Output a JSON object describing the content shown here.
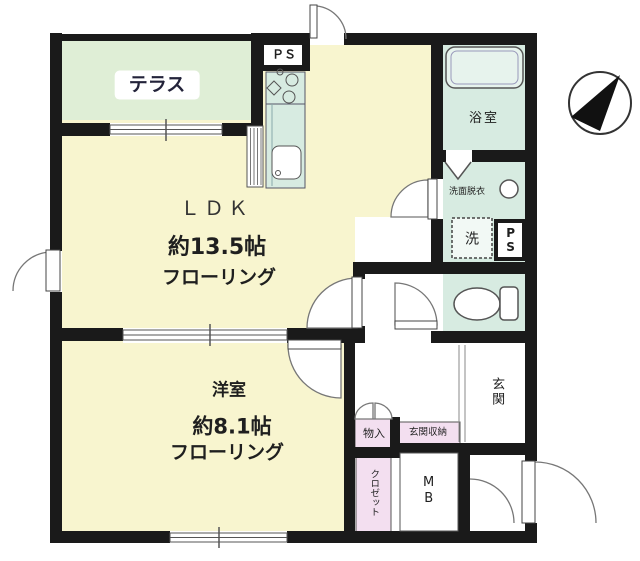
{
  "plan": {
    "colors": {
      "room": "#f8f5cf",
      "terrace": "#dfeed6",
      "wet": "#d7ebe1",
      "storage": "#f3dff0",
      "tub": "#e7f3ed",
      "washer_bg": "#f2f9f5",
      "wall": "#1a1a1a"
    },
    "labels": {
      "terrace": "テラス",
      "ldk": "ＬＤＫ",
      "ldk_size": "約13.5帖",
      "ldk_floor": "フローリング",
      "room": "洋室",
      "room_size": "約8.1帖",
      "room_floor": "フローリング",
      "bath": "浴室",
      "washroom": "洗面脱衣",
      "washer": "洗",
      "ps_top": "ＰＳ",
      "ps_side": "PS",
      "entrance": "玄関",
      "entrance_storage": "玄関収納",
      "storage": "物入",
      "closet": "クロゼット",
      "meter_box": "MB"
    }
  }
}
